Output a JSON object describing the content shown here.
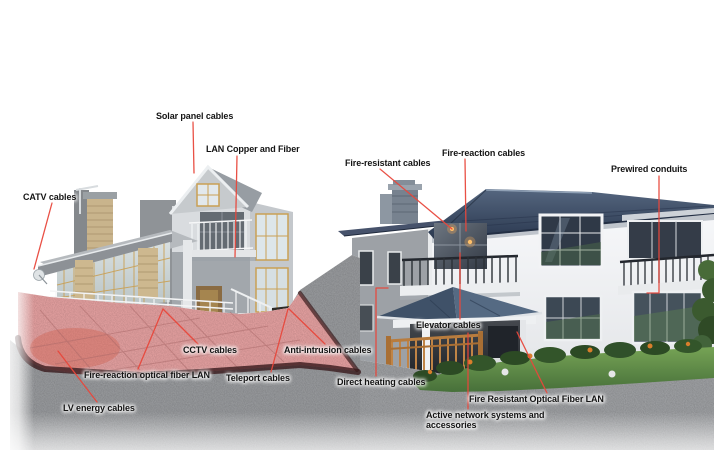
{
  "labels": [
    {
      "id": "solar-panel-cables",
      "text": "Solar panel cables"
    },
    {
      "id": "lan-copper-and-fiber",
      "text": "LAN Copper and Fiber"
    },
    {
      "id": "catv-cables",
      "text": "CATV cables"
    },
    {
      "id": "fire-resistant-cables",
      "text": "Fire-resistant cables"
    },
    {
      "id": "fire-reaction-cables",
      "text": "Fire-reaction cables"
    },
    {
      "id": "prewired-conduits",
      "text": "Prewired conduits"
    },
    {
      "id": "elevator-cables",
      "text": "Elevator cables"
    },
    {
      "id": "cctv-cables",
      "text": "CCTV cables"
    },
    {
      "id": "anti-intrusion-cables",
      "text": "Anti-intrusion cables"
    },
    {
      "id": "fire-reaction-optical-fiber-lan",
      "text": "Fire-reaction optical fiber LAN"
    },
    {
      "id": "teleport-cables",
      "text": "Teleport cables"
    },
    {
      "id": "direct-heating-cables",
      "text": "Direct heating cables"
    },
    {
      "id": "lv-energy-cables",
      "text": "LV energy cables"
    },
    {
      "id": "fire-resistant-optical-fiber-lan",
      "text": "Fire Resistant Optical Fiber LAN"
    },
    {
      "id": "active-network-systems",
      "text": "Active network systems and accessories"
    }
  ],
  "colors": {
    "leader_line": "#e8473b",
    "label_text": "#141414",
    "background": "#ffffff",
    "pavement_highlight": "#e8a3a3",
    "pavement_curb": "#38191b",
    "roof_main": "#3c4c63",
    "lawn_green": "#5d8a44",
    "gravel": "#9b9da0",
    "wood_railing": "#b87c3e",
    "fire_glow": "#e2703a"
  }
}
